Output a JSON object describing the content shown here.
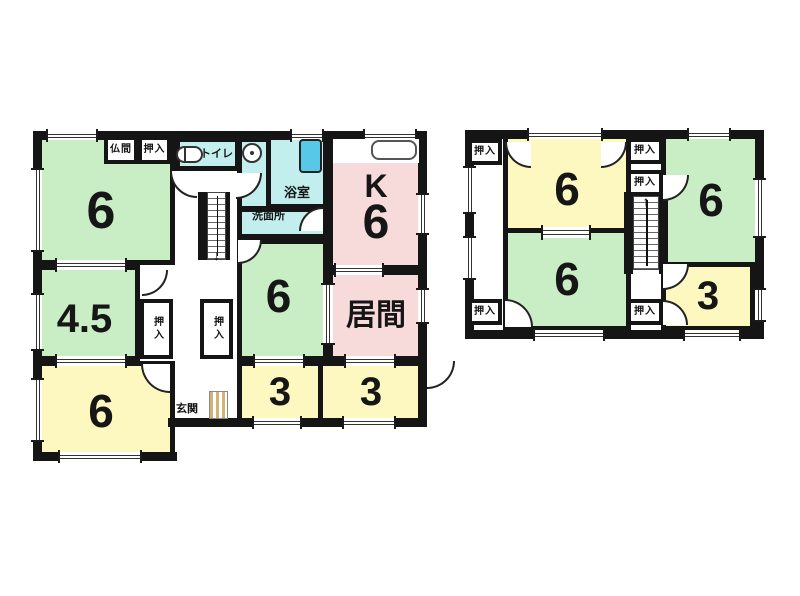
{
  "colors": {
    "wall": "#151515",
    "green": "#c9edc4",
    "yellow": "#fcf8c0",
    "pink": "#f7dbda",
    "cyan": "#c2efed",
    "tub": "#57c8e8",
    "tan": "#d3b374"
  },
  "floors": [
    {
      "id": "floor-1",
      "walls": [
        {
          "x": 33,
          "y": 131,
          "w": 394,
          "h": 9
        },
        {
          "x": 33,
          "y": 131,
          "w": 9,
          "h": 330
        },
        {
          "x": 33,
          "y": 452,
          "w": 144,
          "h": 9
        },
        {
          "x": 168,
          "y": 418,
          "w": 259,
          "h": 9
        },
        {
          "x": 418,
          "y": 131,
          "w": 9,
          "h": 296
        },
        {
          "x": 198,
          "y": 192,
          "w": 9,
          "h": 68
        },
        {
          "x": 226,
          "y": 192,
          "w": 4,
          "h": 68
        }
      ],
      "rooms": [
        {
          "name": "tatami-6-northwest",
          "label": "6",
          "fill": "green",
          "x": 33,
          "y": 131,
          "w": 142,
          "h": 134,
          "fs": 52,
          "dx": -3,
          "dy": 14,
          "tatami": true
        },
        {
          "name": "toilet-room",
          "label": "トイレ",
          "fill": "cyan",
          "x": 175,
          "y": 137,
          "w": 65,
          "h": 34,
          "fs": 11,
          "dx": 9,
          "dy": 0
        },
        {
          "name": "washroom-upper",
          "label": "",
          "fill": "cyan",
          "x": 237,
          "y": 137,
          "w": 37,
          "h": 74,
          "fs": 10
        },
        {
          "name": "bathroom",
          "label": "浴室",
          "fill": "cyan",
          "x": 266,
          "y": 131,
          "w": 62,
          "h": 78,
          "fs": 13,
          "dx": 0,
          "dy": 23
        },
        {
          "name": "washroom",
          "label": "洗面所",
          "fill": "cyan",
          "x": 237,
          "y": 207,
          "w": 91,
          "h": 32,
          "fs": 11,
          "dx": -14,
          "dy": -7
        },
        {
          "name": "kitchen",
          "label": "K",
          "label2": "6",
          "fill": "pink",
          "x": 328,
          "y": 131,
          "w": 96,
          "h": 139,
          "fs": 32,
          "fs2": 48,
          "dx": 0,
          "dy": 8
        },
        {
          "name": "tatami-6-center",
          "label": "6",
          "fill": "green",
          "x": 237,
          "y": 239,
          "w": 91,
          "h": 122,
          "fs": 46,
          "dx": -4,
          "dy": -4,
          "tatami": true
        },
        {
          "name": "living-room",
          "label": "居間",
          "fill": "pink",
          "x": 328,
          "y": 270,
          "w": 96,
          "h": 91,
          "fs": 30,
          "dx": 0,
          "dy": 0
        },
        {
          "name": "tatami-4-5",
          "label": "4.5",
          "fill": "green",
          "x": 33,
          "y": 265,
          "w": 107,
          "h": 96,
          "fs": 40,
          "dx": -2,
          "dy": 6,
          "tatami": true
        },
        {
          "name": "tatami-6-southwest",
          "label": "6",
          "fill": "yellow",
          "x": 33,
          "y": 361,
          "w": 142,
          "h": 96,
          "fs": 46,
          "dx": -3,
          "dy": 2,
          "tatami": true
        },
        {
          "name": "room-3-left",
          "label": "3",
          "fill": "yellow",
          "x": 237,
          "y": 361,
          "w": 86,
          "h": 62,
          "fs": 40,
          "dx": 0,
          "dy": 0
        },
        {
          "name": "room-3-right",
          "label": "3",
          "fill": "yellow",
          "x": 318,
          "y": 361,
          "w": 106,
          "h": 62,
          "fs": 40,
          "dx": 0,
          "dy": 0
        }
      ],
      "closets": [
        {
          "label": "仏間",
          "x": 104,
          "y": 136,
          "w": 34,
          "h": 28,
          "fs": 10
        },
        {
          "label": "押入",
          "x": 138,
          "y": 136,
          "w": 33,
          "h": 28,
          "fs": 10
        },
        {
          "label": "押入",
          "x": 140,
          "y": 299,
          "w": 33,
          "h": 60,
          "fs": 10,
          "vert": true
        },
        {
          "label": "押入",
          "x": 200,
          "y": 299,
          "w": 33,
          "h": 60,
          "fs": 10,
          "vert": true
        }
      ],
      "windows": [
        {
          "x": 46,
          "y": 131,
          "w": 52,
          "h": 9
        },
        {
          "x": 290,
          "y": 131,
          "w": 34,
          "h": 9
        },
        {
          "x": 363,
          "y": 131,
          "w": 54,
          "h": 9
        },
        {
          "x": 33,
          "y": 168,
          "w": 9,
          "h": 84
        },
        {
          "x": 33,
          "y": 293,
          "w": 9,
          "h": 58
        },
        {
          "x": 33,
          "y": 378,
          "w": 9,
          "h": 64
        },
        {
          "x": 58,
          "y": 452,
          "w": 84,
          "h": 9
        },
        {
          "x": 418,
          "y": 193,
          "w": 9,
          "h": 42
        },
        {
          "x": 418,
          "y": 288,
          "w": 9,
          "h": 36
        },
        {
          "x": 252,
          "y": 418,
          "w": 50,
          "h": 9
        },
        {
          "x": 342,
          "y": 418,
          "w": 54,
          "h": 9
        },
        {
          "x": 55,
          "y": 260,
          "w": 72,
          "h": 10
        },
        {
          "x": 55,
          "y": 356,
          "w": 72,
          "h": 10
        },
        {
          "x": 334,
          "y": 265,
          "w": 50,
          "h": 10
        },
        {
          "x": 253,
          "y": 356,
          "w": 52,
          "h": 10
        },
        {
          "x": 344,
          "y": 356,
          "w": 52,
          "h": 10
        },
        {
          "x": 323,
          "y": 283,
          "w": 10,
          "h": 62
        }
      ],
      "stairs": [
        {
          "x": 207,
          "y": 192,
          "w": 19,
          "h": 68,
          "dir": "down"
        }
      ],
      "arcs": [
        {
          "x": 236,
          "y": 173,
          "s": 26,
          "c": "br"
        },
        {
          "x": 170,
          "y": 171,
          "s": 27,
          "c": "bl"
        },
        {
          "x": 299,
          "y": 207,
          "s": 24,
          "c": "tl"
        },
        {
          "x": 238,
          "y": 240,
          "s": 24,
          "c": "br"
        },
        {
          "x": 142,
          "y": 270,
          "s": 26,
          "c": "br"
        },
        {
          "x": 141,
          "y": 364,
          "s": 29,
          "c": "bl"
        },
        {
          "x": 427,
          "y": 361,
          "s": 28,
          "c": "br"
        }
      ],
      "icons": [
        {
          "type": "toilet",
          "x": 176,
          "y": 146,
          "w": 27,
          "h": 17
        },
        {
          "type": "basin",
          "x": 242,
          "y": 143,
          "w": 20,
          "h": 20
        },
        {
          "type": "tub",
          "x": 299,
          "y": 139,
          "w": 23,
          "h": 34
        },
        {
          "type": "counter",
          "x": 333,
          "y": 139,
          "w": 86,
          "h": 24
        },
        {
          "type": "step",
          "x": 209,
          "y": 391,
          "w": 19,
          "h": 28
        }
      ],
      "labels": [
        {
          "text": "玄関",
          "x": 165,
          "y": 400,
          "w": 44,
          "h": 15,
          "fs": 11
        }
      ]
    },
    {
      "id": "floor-2",
      "walls": [
        {
          "x": 465,
          "y": 130,
          "w": 299,
          "h": 9
        },
        {
          "x": 465,
          "y": 130,
          "w": 9,
          "h": 209
        },
        {
          "x": 755,
          "y": 130,
          "w": 9,
          "h": 209
        },
        {
          "x": 465,
          "y": 330,
          "w": 299,
          "h": 9
        },
        {
          "x": 624,
          "y": 192,
          "w": 9,
          "h": 82
        },
        {
          "x": 659,
          "y": 192,
          "w": 9,
          "h": 82
        }
      ],
      "rooms": [
        {
          "name": "tatami-6-2f-top",
          "label": "6",
          "fill": "yellow",
          "x": 503,
          "y": 133,
          "w": 128,
          "h": 100,
          "fs": 46,
          "dx": 0,
          "dy": 6,
          "tatami": true
        },
        {
          "name": "tatami-6-2f-right",
          "label": "6",
          "fill": "green",
          "x": 661,
          "y": 133,
          "w": 100,
          "h": 134,
          "fs": 46,
          "dx": 0,
          "dy": 0,
          "tatami": true
        },
        {
          "name": "tatami-6-2f-bottom",
          "label": "6",
          "fill": "green",
          "x": 503,
          "y": 228,
          "w": 128,
          "h": 103,
          "fs": 46,
          "dx": 0,
          "dy": 0,
          "tatami": true
        },
        {
          "name": "room-3-2f",
          "label": "3",
          "fill": "yellow",
          "x": 661,
          "y": 262,
          "w": 94,
          "h": 69,
          "fs": 40,
          "dx": 0,
          "dy": 0
        }
      ],
      "closets": [
        {
          "label": "押入",
          "x": 468,
          "y": 139,
          "w": 34,
          "h": 26,
          "fs": 10
        },
        {
          "label": "押入",
          "x": 627,
          "y": 138,
          "w": 36,
          "h": 26,
          "fs": 10
        },
        {
          "label": "押入",
          "x": 627,
          "y": 170,
          "w": 36,
          "h": 26,
          "fs": 10
        },
        {
          "label": "押入",
          "x": 468,
          "y": 299,
          "w": 34,
          "h": 26,
          "fs": 10
        },
        {
          "label": "押入",
          "x": 627,
          "y": 299,
          "w": 36,
          "h": 26,
          "fs": 10
        }
      ],
      "windows": [
        {
          "x": 465,
          "y": 166,
          "w": 9,
          "h": 48
        },
        {
          "x": 465,
          "y": 236,
          "w": 9,
          "h": 44
        },
        {
          "x": 527,
          "y": 130,
          "w": 76,
          "h": 9
        },
        {
          "x": 687,
          "y": 130,
          "w": 44,
          "h": 9
        },
        {
          "x": 755,
          "y": 178,
          "w": 9,
          "h": 60
        },
        {
          "x": 755,
          "y": 288,
          "w": 9,
          "h": 34
        },
        {
          "x": 533,
          "y": 330,
          "w": 72,
          "h": 9
        },
        {
          "x": 683,
          "y": 330,
          "w": 58,
          "h": 9
        },
        {
          "x": 541,
          "y": 227,
          "w": 50,
          "h": 11
        }
      ],
      "stairs": [
        {
          "x": 633,
          "y": 196,
          "w": 26,
          "h": 74,
          "dir": "up"
        }
      ],
      "arcs": [
        {
          "x": 505,
          "y": 142,
          "s": 26,
          "c": "bl"
        },
        {
          "x": 601,
          "y": 142,
          "s": 26,
          "c": "br"
        },
        {
          "x": 663,
          "y": 175,
          "s": 26,
          "c": "br"
        },
        {
          "x": 505,
          "y": 299,
          "s": 28,
          "c": "tr"
        },
        {
          "x": 663,
          "y": 264,
          "s": 26,
          "c": "br"
        },
        {
          "x": 663,
          "y": 300,
          "s": 25,
          "c": "tr"
        }
      ],
      "icons": [],
      "labels": []
    }
  ]
}
